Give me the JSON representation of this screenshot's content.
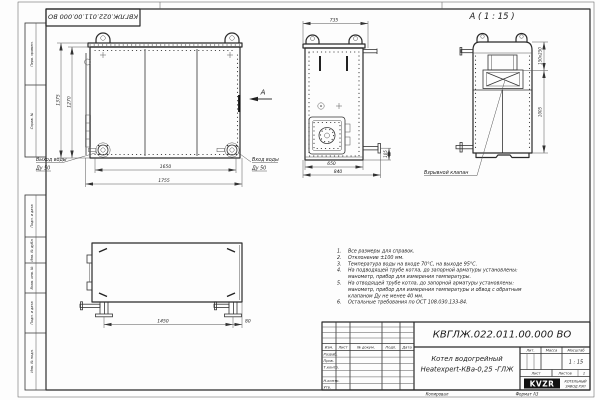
{
  "doc_number_stamp": "КВГЛЖ.022.011.00.000 ВО",
  "margin_stamps": {
    "perv_primen": "Перв. примен.",
    "sprav_no": "Справ. №",
    "podp_data_1": "Подп. и дата",
    "inv_dubl": "Инв. № дубл.",
    "vzam_inv": "Взам. инв. №",
    "podp_data_2": "Подп. и дата",
    "inv_podl": "Инв. № подл."
  },
  "fr": {
    "dim_height_outer": "1375",
    "dim_height_inner": "1270",
    "dim_width_inner": "1650",
    "dim_width_outer": "1755",
    "outlet1": "Выход воды",
    "outlet2": "Ду 50",
    "inlet1": "Вход воды",
    "inlet2": "Ду 50",
    "arrow": "А"
  },
  "sd": {
    "dim_top": "735",
    "dim_in": "650",
    "dim_out": "840",
    "dim_pipe": "105"
  },
  "rr": {
    "title": "А ( 1 : 15 )",
    "dim_valve": "150x250",
    "dim_h": "1005",
    "valve_label": "Взрывной клапан"
  },
  "bt": {
    "dim_len": "1450",
    "dim_off": "80"
  },
  "notes": {
    "n1": "1.",
    "n2": "2.",
    "n3": "3.",
    "n4": "4.",
    "n5": "5.",
    "n6": "6.",
    "l1": "Все размеры для справок.",
    "l2": "Отклонение ±100 мм.",
    "l3": "Температура воды на входе 70°С, на выходе 95°С.",
    "l4a": "На подводящей трубе котла, до запорной арматуры установлены:",
    "l4b": "манометр, прибор для измерения температуры.",
    "l5a": "На отводящей трубе котла, до запорной арматуры установлены:",
    "l5b": "манометр, прибор для измерения температуры и обвод с обратным",
    "l5c": "клапаном Ду не менее 40 мм.",
    "l6": "Остальные требования по ОСТ 108.030.133-84."
  },
  "tb": {
    "doc_number": "КВГЛЖ.022.011.00.000 ВО",
    "name1": "Котел водогрейный",
    "name2": "Heatexpert-КВа-0,25 -ГЛЖ",
    "h_izm": "Изм.",
    "h_list": "Лист",
    "h_docnum": "№ докум.",
    "h_podp": "Подп.",
    "h_data": "Дата",
    "r_razrab": "Разраб.",
    "r_prov": "Пров.",
    "r_tkontr": "Т.контр.",
    "r_nkontr": "Н.контр.",
    "r_utv": "Утв.",
    "h_lit": "Лит.",
    "h_massa": "Масса",
    "h_scale": "Масштаб",
    "scale": "1 : 15",
    "list": "Лист",
    "listov": "Листов",
    "listov_val": "1",
    "logo": "KVZR",
    "logo_cap1": "КОТЕЛЬНЫЙ",
    "logo_cap2": "ЗАВОД РЭП",
    "kopiroval": "Копировал",
    "format": "Формат А3"
  }
}
